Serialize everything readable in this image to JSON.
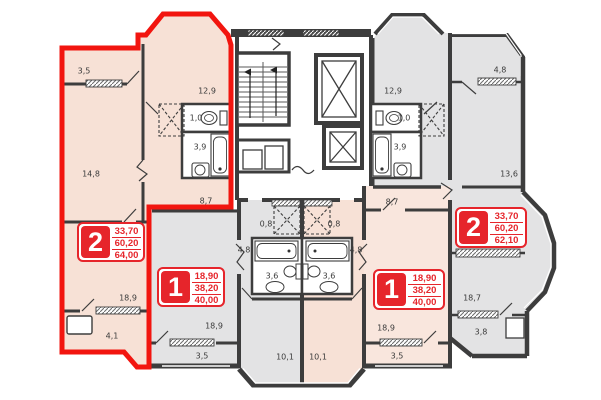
{
  "plan": {
    "title": "apartment-floor-plan",
    "apartments": [
      {
        "num": "2",
        "a1": "33,70",
        "a2": "60,20",
        "a3": "64,00"
      },
      {
        "num": "1",
        "a1": "18,90",
        "a2": "38,20",
        "a3": "40,00"
      },
      {
        "num": "1",
        "a1": "18,90",
        "a2": "38,20",
        "a3": "40,00"
      },
      {
        "num": "2",
        "a1": "33,70",
        "a2": "60,20",
        "a3": "62,10"
      }
    ],
    "room_labels": [
      {
        "t": "3,5"
      },
      {
        "t": "12,9"
      },
      {
        "t": "1,0"
      },
      {
        "t": "3,9"
      },
      {
        "t": "14,8"
      },
      {
        "t": "8,7"
      },
      {
        "t": "18,9"
      },
      {
        "t": "4,1"
      },
      {
        "t": "18,9"
      },
      {
        "t": "3,5"
      },
      {
        "t": "0,8"
      },
      {
        "t": "0,8"
      },
      {
        "t": "4,8"
      },
      {
        "t": "4,8"
      },
      {
        "t": "3,6"
      },
      {
        "t": "3,6"
      },
      {
        "t": "10,1"
      },
      {
        "t": "10,1"
      },
      {
        "t": "12,9"
      },
      {
        "t": "1,0"
      },
      {
        "t": "3,9"
      },
      {
        "t": "8,7"
      },
      {
        "t": "4,8"
      },
      {
        "t": "13,6"
      },
      {
        "t": "18,9"
      },
      {
        "t": "3,5"
      },
      {
        "t": "18,7"
      },
      {
        "t": "3,8"
      }
    ],
    "colors": {
      "highlight_red": "#f2150f",
      "badge_red": "#e6252b",
      "apartment_warm": "#f7e1d6",
      "apartment_gray": "#e3e3e4",
      "wall": "#3d3d3d"
    }
  }
}
